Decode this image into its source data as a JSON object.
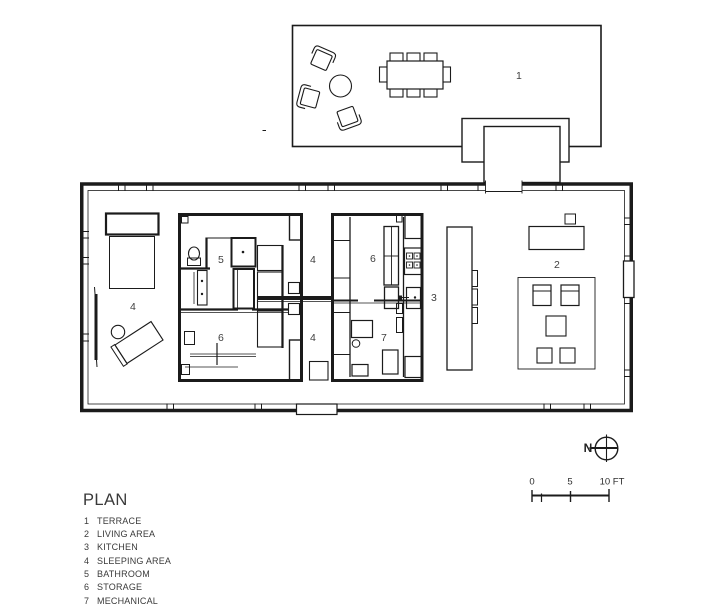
{
  "drawing": {
    "title": "PLAN",
    "north_label": "N",
    "scale": {
      "tick0": "0",
      "tick5": "5",
      "tick10": "10 FT"
    },
    "room_labels": [
      {
        "num": "1",
        "room": "terrace"
      },
      {
        "num": "4",
        "room": "sleeping-area-west"
      },
      {
        "num": "5",
        "room": "bathroom"
      },
      {
        "num": "6",
        "room": "storage-core-1"
      },
      {
        "num": "4",
        "room": "sleeping-area-middle-north"
      },
      {
        "num": "6",
        "room": "storage-core-2"
      },
      {
        "num": "3",
        "room": "kitchen"
      },
      {
        "num": "4",
        "room": "sleeping-area-middle-south"
      },
      {
        "num": "7",
        "room": "mechanical"
      },
      {
        "num": "2",
        "room": "living-area"
      }
    ],
    "legend": {
      "items": [
        {
          "num": "1",
          "label": "TERRACE"
        },
        {
          "num": "2",
          "label": "LIVING AREA"
        },
        {
          "num": "3",
          "label": "KITCHEN"
        },
        {
          "num": "4",
          "label": "SLEEPING AREA"
        },
        {
          "num": "5",
          "label": "BATHROOM"
        },
        {
          "num": "6",
          "label": "STORAGE"
        },
        {
          "num": "7",
          "label": "MECHANICAL"
        }
      ]
    },
    "colors": {
      "line": "#1b1b1b",
      "label": "#3f3f3f",
      "background": "#ffffff"
    }
  }
}
